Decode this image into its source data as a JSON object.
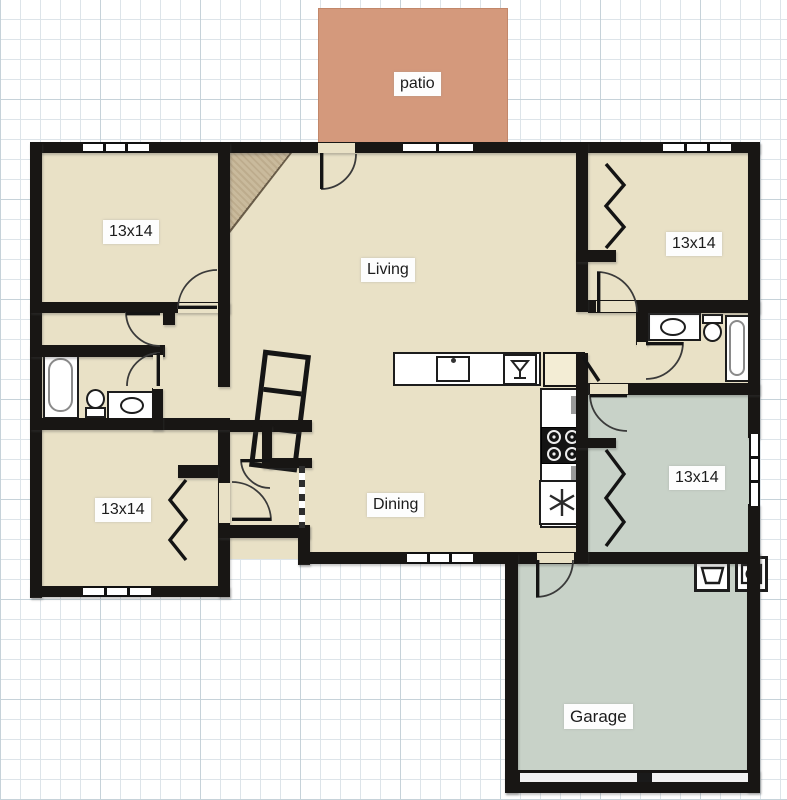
{
  "labels": {
    "patio": "patio",
    "living": "Living",
    "dining": "Dining",
    "garage": "Garage",
    "bedroom_top_left": "13x14",
    "bedroom_top_right": "13x14",
    "bedroom_bottom_left": "13x14",
    "bedroom_right": "13x14"
  },
  "colors": {
    "floor": "#e9e1c6",
    "green": "#c8d2c8",
    "patio": "#d4997c",
    "patio_edge": "#c2876a",
    "wall": "#181614",
    "grid": "#dde4e9",
    "grid_strong": "#c6d2d9",
    "label_bg": "#fdfdfd",
    "pantry": "#f3edd5",
    "fireplace": "#c9ba9c"
  },
  "fixtures": [
    "bathtub",
    "toilet",
    "vanity-sink",
    "kitchen-sink",
    "dishwasher",
    "stove",
    "refrigerator",
    "pantry",
    "washer",
    "dryer",
    "fireplace",
    "shelf-unit",
    "bifold-closet-doors",
    "garage-door",
    "patio"
  ]
}
